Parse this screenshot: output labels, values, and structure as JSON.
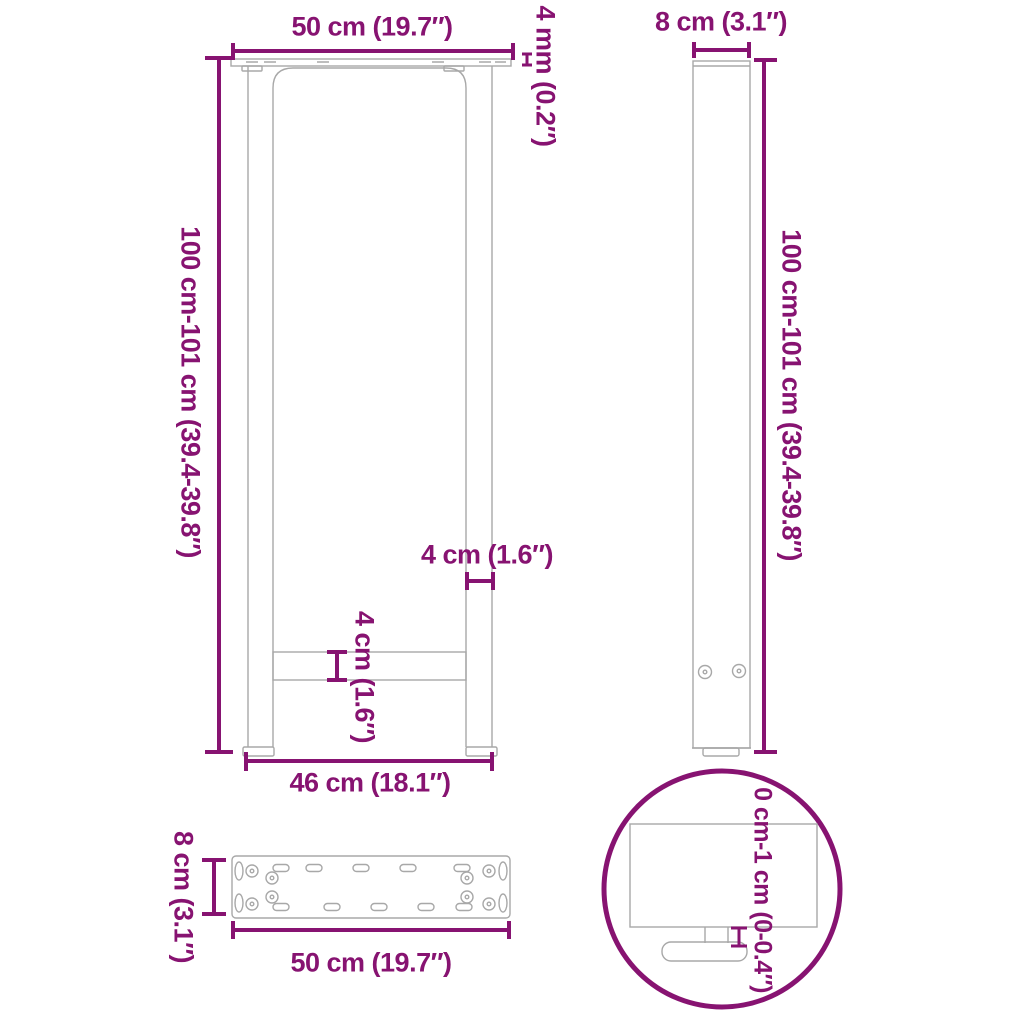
{
  "colors": {
    "accent": "#871371",
    "line": "#a8a8a8",
    "background": "#ffffff"
  },
  "diagram_title": "Coffee table legs dimension diagram",
  "views": {
    "front": {
      "top_width": "50 cm (19.7″)",
      "plate_thickness": "4 mm (0.2″)",
      "height": "100 cm-101 cm (39.4-39.8″)",
      "leg_width": "4 cm (1.6″)",
      "crossbar_height": "4 cm (1.6″)",
      "bottom_width": "46 cm (18.1″)"
    },
    "side": {
      "depth": "8 cm (3.1″)",
      "height": "100 cm-101 cm (39.4-39.8″)"
    },
    "plate_top": {
      "depth": "8 cm (3.1″)",
      "width": "50 cm (19.7″)"
    },
    "detail": {
      "adjustable_foot_range": "0 cm-1 cm (0-0.4″)"
    }
  }
}
